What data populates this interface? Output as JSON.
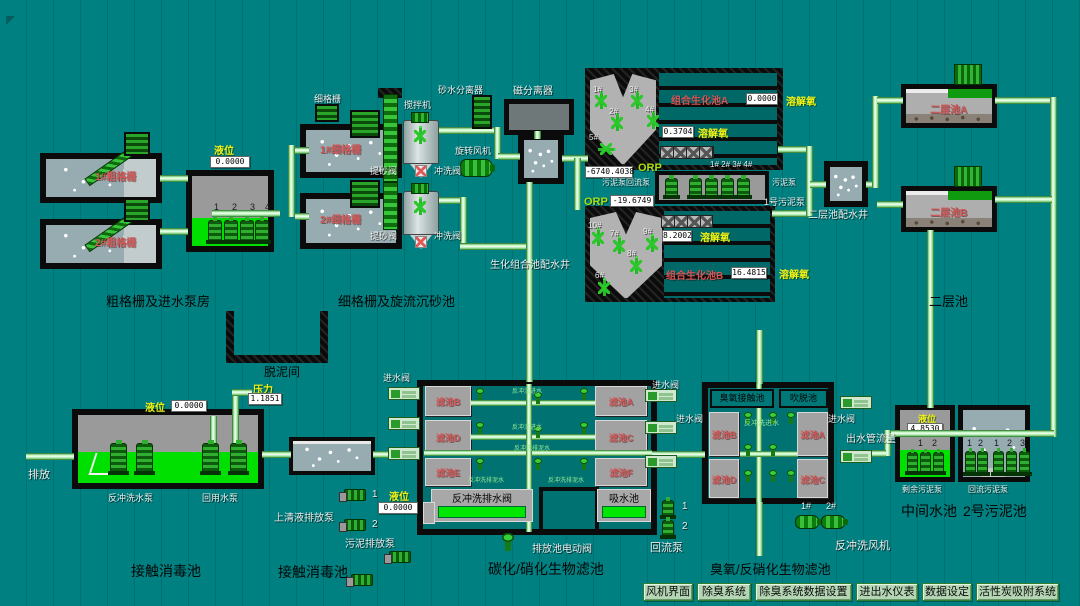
{
  "coarse": {
    "title": "粗格栅及进水泵房",
    "tank1": "1#粗格栅",
    "tank2": "2#粗格栅",
    "level_label": "液位",
    "level_value": "0.0000",
    "pump_numbers": [
      "1",
      "2",
      "3",
      "4"
    ]
  },
  "fine": {
    "title": "细格栅及旋流沉砂池",
    "screen_label": "细格栅",
    "mixer_label": "搅拌机",
    "tank1": "1#细格栅",
    "tank2": "2#细格栅",
    "grit_valve": "提砂阀",
    "flush_valve": "冲洗阀",
    "sand_separator": "砂水分离器",
    "magnetic_separator": "磁分离器",
    "rotary_fan": "旋转风机",
    "distribution_well": "生化组合池配水井"
  },
  "bio": {
    "pool_a": "组合生化池A",
    "pool_a_value": "0.0000",
    "pool_a_do": "0.3704",
    "pool_b": "组合生化池B",
    "pool_b_value": "16.4815",
    "pool_b_do": "8.2002",
    "do_label": "溶解氧",
    "orp_label": "ORP",
    "orp_a": "-6740.4038",
    "orp_b": "-19.6749",
    "mixers_a": [
      "1#",
      "2#",
      "3#",
      "4#",
      "5#"
    ],
    "mixers_b": [
      "6#",
      "7#",
      "8#",
      "9#",
      "10#"
    ],
    "pump_numbers": "1# 2# 3# 4#",
    "return_label": "污泥泵回流泵",
    "sludge_pump": "污泥泵",
    "sludge_pump_no1": "1号污泥泵"
  },
  "secondary": {
    "title": "二层池",
    "well": "二层池配水井",
    "tank_a": "二层池A",
    "tank_b": "二层池B"
  },
  "contact1": {
    "title": "接触消毒池",
    "discharge": "排放",
    "level_label": "液位",
    "level_value": "0.0000",
    "pressure_label": "压力",
    "pressure_value": "1.1851",
    "backwash_pump": "反冲洗水泵",
    "reuse_pump": "回用水泵"
  },
  "dewater": {
    "label": "脱泥间"
  },
  "contact2": {
    "title": "接触消毒池",
    "supernatant": "上清液排放泵",
    "sludge_discharge": "污泥排放泵",
    "level_label": "液位",
    "level_value": "0.0000",
    "pump1": "1",
    "pump2": "2"
  },
  "carbon": {
    "title": "碳化/硝化生物滤池",
    "inlet_valve": "进水阀",
    "cells": [
      "滤池B",
      "滤池A",
      "滤池D",
      "滤池C",
      "滤池E",
      "滤池F"
    ],
    "backwash_in": "反冲洗进水",
    "backwash_drain": "反冲洗排泥水",
    "backwash_drain_valve": "反冲洗排水阀",
    "suction": "吸水池",
    "drain_valve": "排放池电动阀"
  },
  "ozone": {
    "title": "臭氧/反硝化生物滤池",
    "contact": "臭氧接触池",
    "stripping": "吹脱池",
    "cells": [
      "滤池B",
      "滤池A",
      "滤池D",
      "滤池C"
    ],
    "backwash_in": "反冲洗进水",
    "inlet_valve": "进水阀",
    "outflow": "出水管流量",
    "return_pump": "回流泵",
    "return_1": "1",
    "return_2": "2",
    "fan_label": "反冲洗风机",
    "fan_1": "1#",
    "fan_2": "2#"
  },
  "mid": {
    "title": "中间水池",
    "level_label": "液位",
    "level_value": "4.8530",
    "num1": "1",
    "num2": "2",
    "pump_label": "剩余污泥泵"
  },
  "sludge2": {
    "title": "2号污泥池",
    "nums": [
      "1",
      "2",
      "1",
      "2",
      "3"
    ],
    "pump_label": "回流污泥泵"
  },
  "nav": {
    "buttons": [
      "风机界面",
      "除臭系统",
      "除臭系统数据设置",
      "进出水仪表",
      "数据设定",
      "活性炭吸附系统"
    ]
  },
  "colors": {
    "background": "#008080",
    "pipe": "#bdf7bd",
    "tank_name_red": "#d05858",
    "label_yellow": "#f0f018",
    "fill_green": "#00e000"
  }
}
